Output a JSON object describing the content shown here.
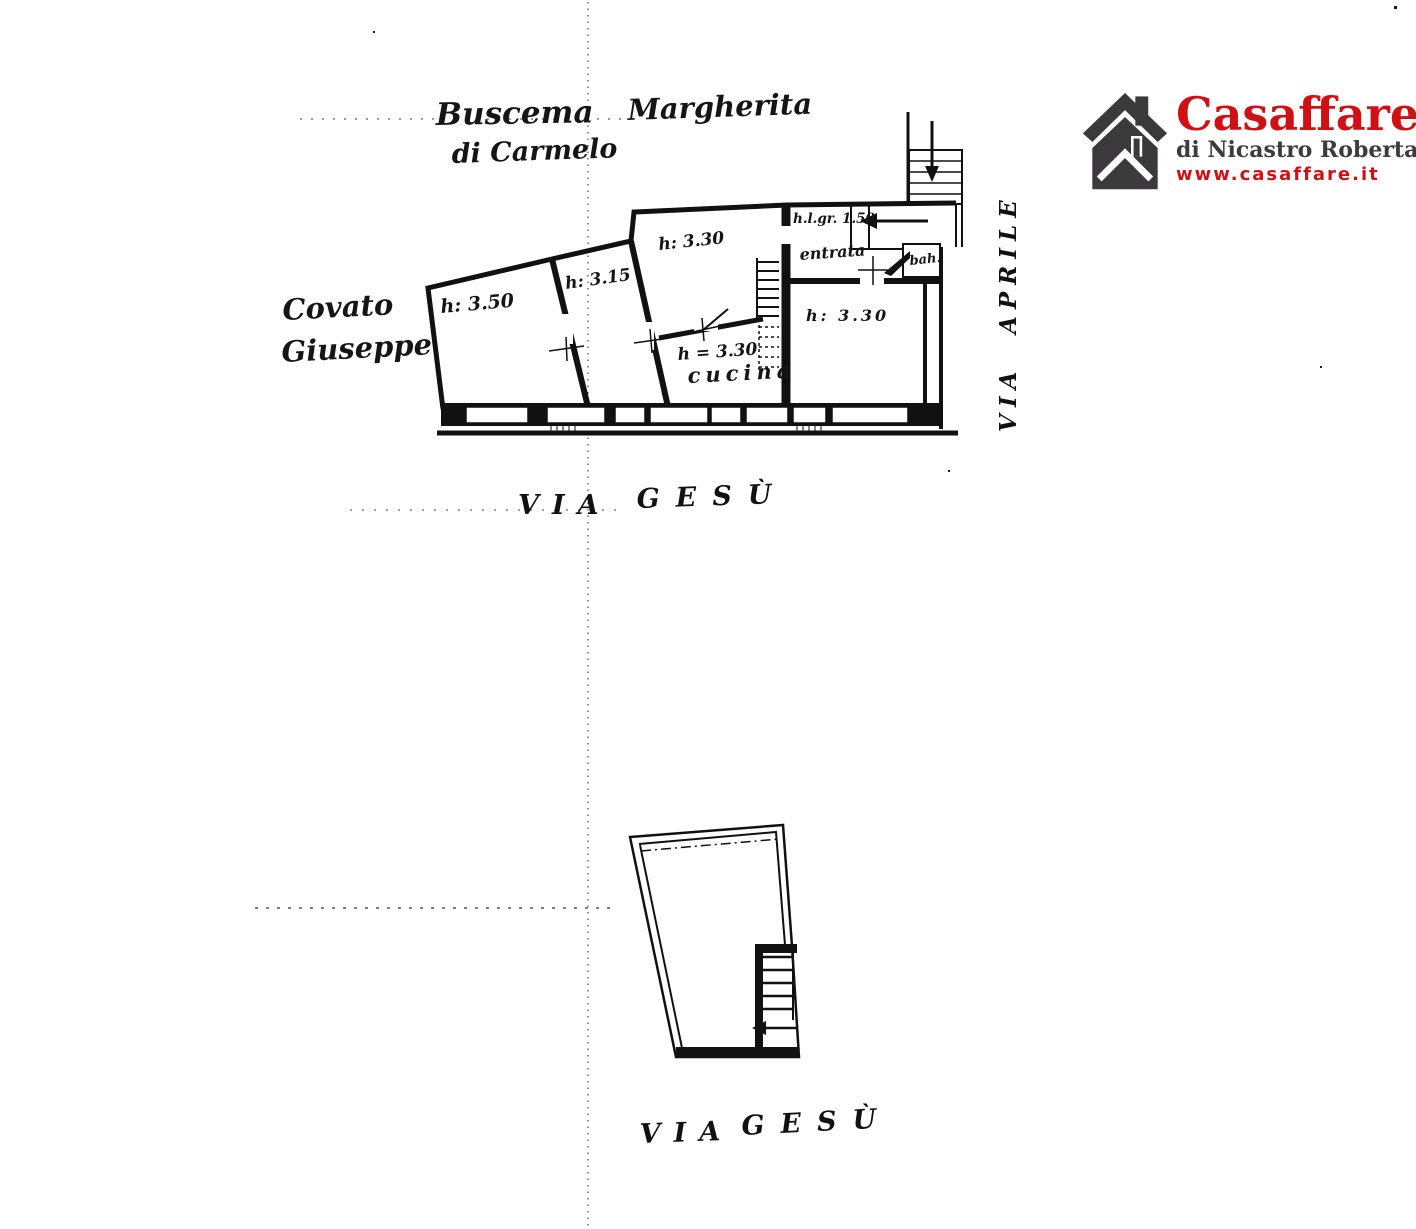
{
  "page": {
    "background": "#ffffff",
    "ink": "#141414"
  },
  "logo": {
    "brand": "Casaffare",
    "subtitle": "di Nicastro Roberta",
    "website": "www.casaffare.it",
    "brand_color": "#cf1116",
    "subtitle_color": "#3d3b3d",
    "icon": "house-icon",
    "icon_color": "#3b393b"
  },
  "annotations": {
    "owner_name_first": "Buscema",
    "owner_name_last": "Margherita",
    "owner_line2": "di Carmelo",
    "neighbor_first": "Covato",
    "neighbor_last": "Giuseppe"
  },
  "main_plan": {
    "room_left_height": "h: 3.50",
    "room_second_height": "h: 3.15",
    "room_middle_height": "h: 3.30",
    "kitchen_height": "h = 3.30",
    "kitchen_label": "cucina",
    "room_right_height": "h: 3.30",
    "entry_height_note": "h.l.gr. 1.50",
    "entry_label": "entrata",
    "bath_label": "bah.",
    "street_word1": "VIA",
    "street_word2": "GESÙ",
    "side_street_word1": "VIA",
    "side_street_word2": "APRILE"
  },
  "lower_plan": {
    "street_word1": "VIA",
    "street_word2": "GESÙ"
  }
}
